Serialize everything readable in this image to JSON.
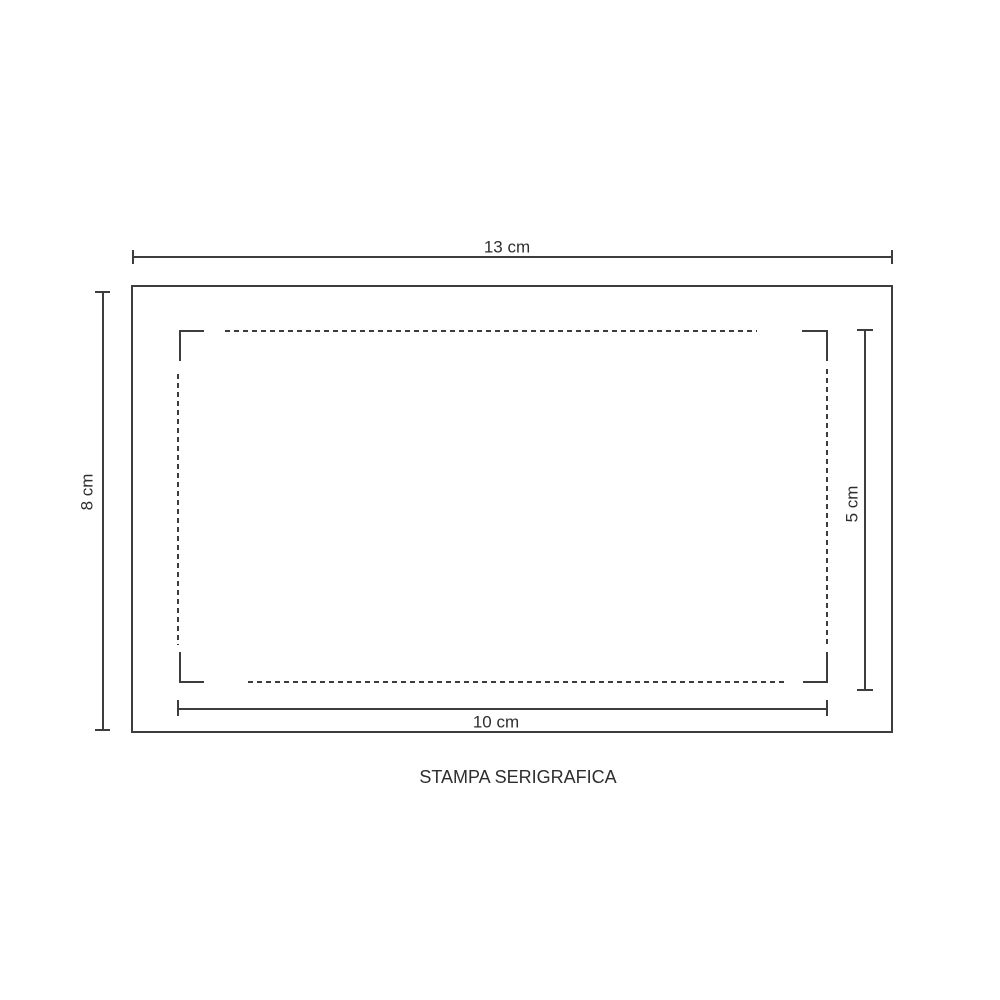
{
  "diagram": {
    "caption": "STAMPA SERIGRAFICA",
    "dimensions": {
      "outer_width": {
        "label": "13 cm"
      },
      "outer_height": {
        "label": "8 cm"
      },
      "print_width": {
        "label": "10 cm"
      },
      "print_height": {
        "label": "5 cm"
      }
    },
    "colors": {
      "line": "#3d3d3d",
      "text": "#2e2e2e",
      "background": "#ffffff"
    }
  }
}
